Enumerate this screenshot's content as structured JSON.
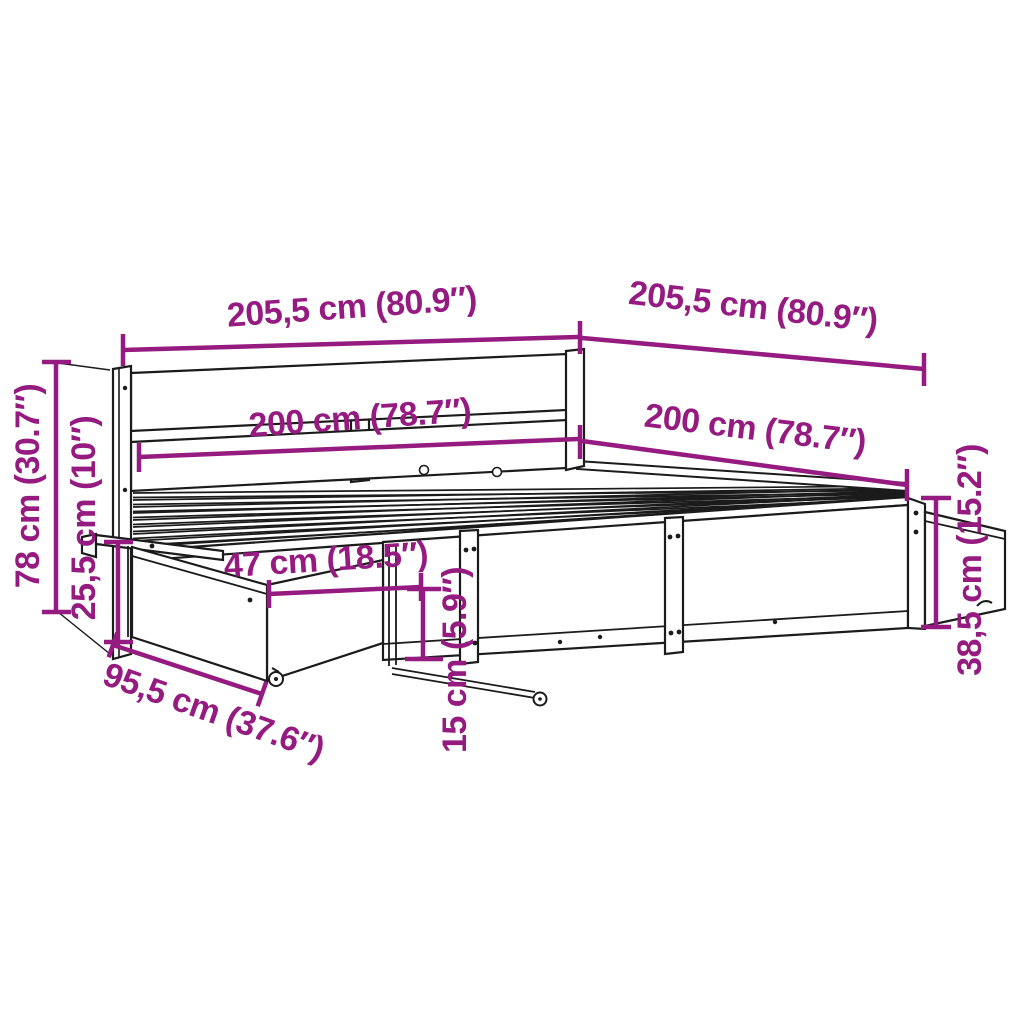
{
  "diagram": {
    "type": "furniture-dimension-diagram",
    "subject": "bed frame with headboard, slatted base and storage drawers",
    "background_color": "#ffffff",
    "line_color": "#1b1b1b",
    "dimension_color": "#951b81",
    "dimensions": [
      {
        "name": "headboard-overall-width",
        "label": "205,5 cm (80.9″)",
        "value_cm": 205.5,
        "value_in": 80.9
      },
      {
        "name": "frame-overall-length",
        "label": "205,5 cm (80.9″)",
        "value_cm": 205.5,
        "value_in": 80.9
      },
      {
        "name": "mattress-width",
        "label": "200 cm (78.7″)",
        "value_cm": 200,
        "value_in": 78.7
      },
      {
        "name": "mattress-length",
        "label": "200 cm (78.7″)",
        "value_cm": 200,
        "value_in": 78.7
      },
      {
        "name": "headboard-height",
        "label": "78 cm (30.7″)",
        "value_cm": 78,
        "value_in": 30.7
      },
      {
        "name": "drawer-front-height",
        "label": "25,5 cm (10″)",
        "value_cm": 25.5,
        "value_in": 10
      },
      {
        "name": "drawer-extension",
        "label": "47 cm (18.5″)",
        "value_cm": 47,
        "value_in": 18.5
      },
      {
        "name": "ground-clearance",
        "label": "15 cm (5.9″)",
        "value_cm": 15,
        "value_in": 5.9
      },
      {
        "name": "drawer-width",
        "label": "95,5 cm (37.6″)",
        "value_cm": 95.5,
        "value_in": 37.6
      },
      {
        "name": "side-rail-height",
        "label": "38,5 cm (15.2″)",
        "value_cm": 38.5,
        "value_in": 15.2
      }
    ]
  }
}
